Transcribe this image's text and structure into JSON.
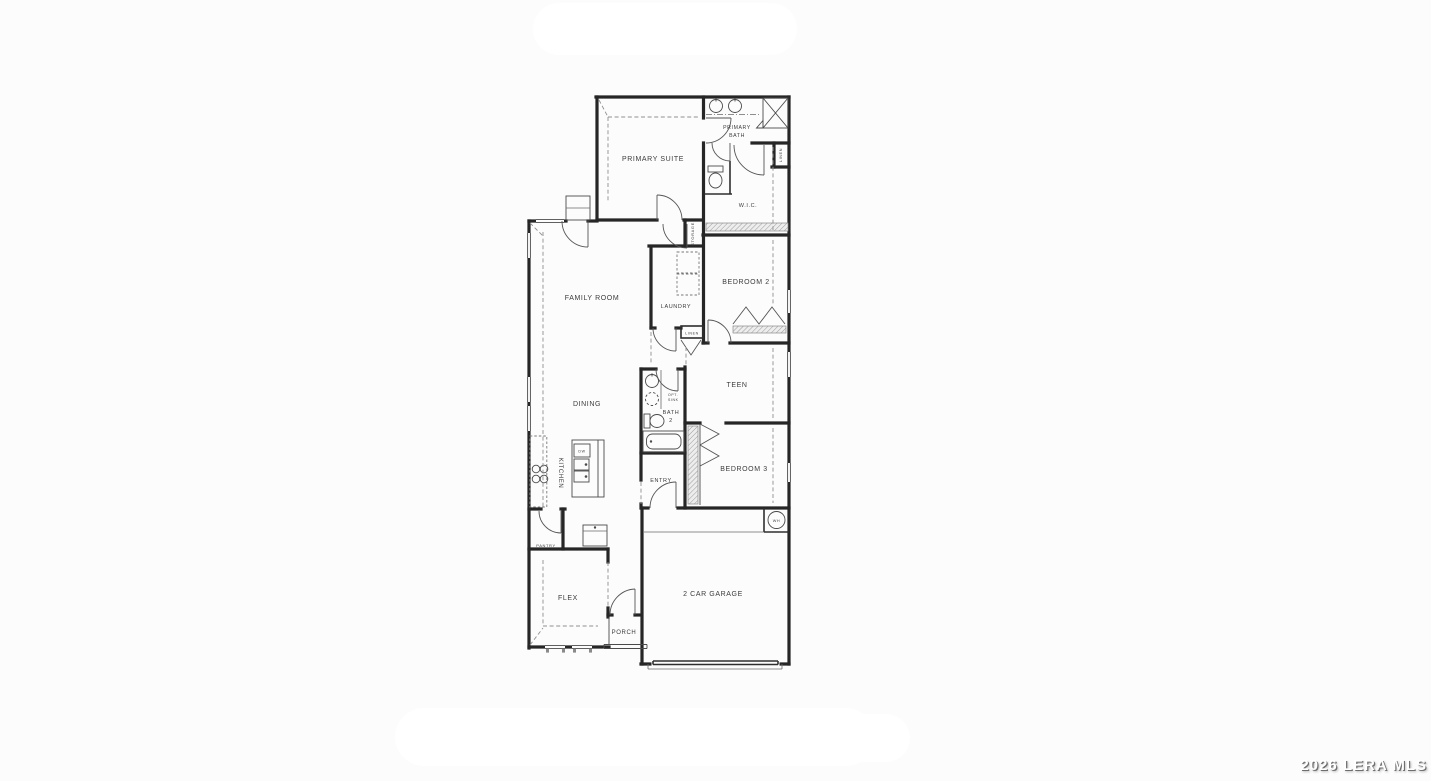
{
  "watermark": {
    "text": "2026 LERA MLS"
  },
  "floor_plan": {
    "rooms": {
      "primary_suite": "PRIMARY SUITE",
      "primary_bath_line1": "PRIMARY",
      "primary_bath_line2": "BATH",
      "wic": "W.I.C.",
      "linen_upper": "LINEN",
      "storage": "STORAGE",
      "family_room": "FAMILY ROOM",
      "laundry": "LAUNDRY",
      "bedroom2": "BEDROOM 2",
      "linen_hall": "LINEN",
      "teen": "TEEN",
      "dining": "DINING",
      "bath2_line1": "BATH",
      "bath2_line2": "2",
      "opt_sink_line1": "OPT.",
      "opt_sink_line2": "SINK",
      "kitchen": "KITCHEN",
      "dw": "DW",
      "bedroom3": "BEDROOM 3",
      "entry": "ENTRY",
      "wh": "WH",
      "pantry": "PANTRY",
      "flex": "FLEX",
      "porch": "PORCH",
      "garage": "2 CAR GARAGE"
    }
  }
}
